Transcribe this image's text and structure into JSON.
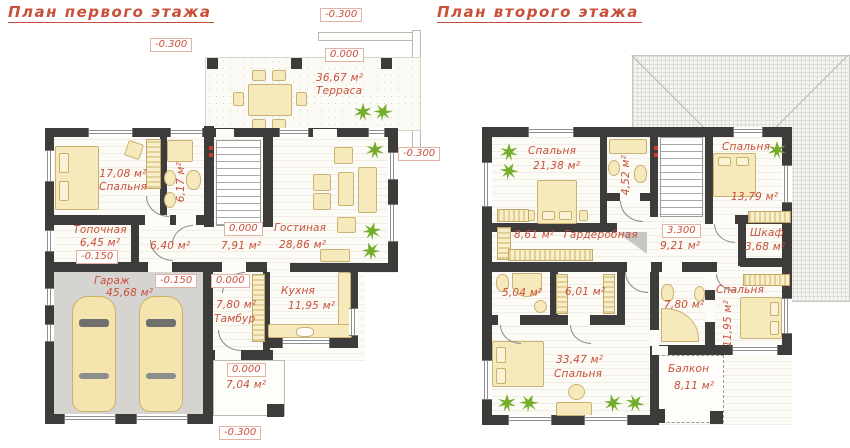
{
  "drawing": {
    "kind": "house floor plans, architectural drawing",
    "colors": {
      "label_red": "#c8503a",
      "wall_dark": "#3d3c3a",
      "furniture_cream": "#f6e9bb",
      "garage_floor_gray": "#d5d4d1",
      "plant_green": "#74ac2c"
    }
  },
  "floor1": {
    "title": "План первого этажа",
    "terrace": {
      "area": "36,67 м²",
      "name": "Терраса",
      "level": "0.000"
    },
    "bedroom": {
      "area": "17,08 м²",
      "name": "Спальня"
    },
    "bath": {
      "area": "6,17 м²"
    },
    "boiler": {
      "name": "Топочная",
      "area": "6,45 м²",
      "level": "-0.150"
    },
    "hall": {
      "area": "6,40 м²"
    },
    "stair_hall": {
      "level": "0.000",
      "area": "7,91 м²"
    },
    "living": {
      "name": "Гостиная",
      "area": "28,86 м²"
    },
    "garage": {
      "name": "Гараж",
      "area": "45,68 м²",
      "level": "-0.150"
    },
    "tambour": {
      "level": "0.000",
      "area": "7,80 м²",
      "name": "Тамбур"
    },
    "kitchen": {
      "name": "Кухня",
      "area": "11,95 м²"
    },
    "porch": {
      "level": "0.000",
      "area": "7,04 м²"
    },
    "elev_top": "-0.300",
    "elev_terrace_left": "-0.300",
    "elev_right": "-0.300",
    "elev_bottom": "-0.300"
  },
  "floor2": {
    "title": "План второго этажа",
    "bedroom1": {
      "name": "Спальня",
      "area": "21,38 м²"
    },
    "bath1": {
      "area": "4,52 м²"
    },
    "bedroom2": {
      "name": "Спальня",
      "area": "13,79 м²"
    },
    "wardrobe": {
      "area": "8,61 м²",
      "name": "Гардеробная"
    },
    "hall": {
      "level": "3.300",
      "area": "9,21 м²"
    },
    "closet": {
      "name": "Шкаф",
      "area": "3,68 м²"
    },
    "bath2": {
      "area": "5,04 м²"
    },
    "storage": {
      "area": "6,01 м²"
    },
    "bath3": {
      "area": "7,80 м²"
    },
    "bedroom3": {
      "name": "Спальня",
      "area": "11,95 м²"
    },
    "bedroom4": {
      "area": "33,47 м²",
      "name": "Спальня"
    },
    "balcony": {
      "name": "Балкон",
      "area": "8,11 м²"
    }
  }
}
